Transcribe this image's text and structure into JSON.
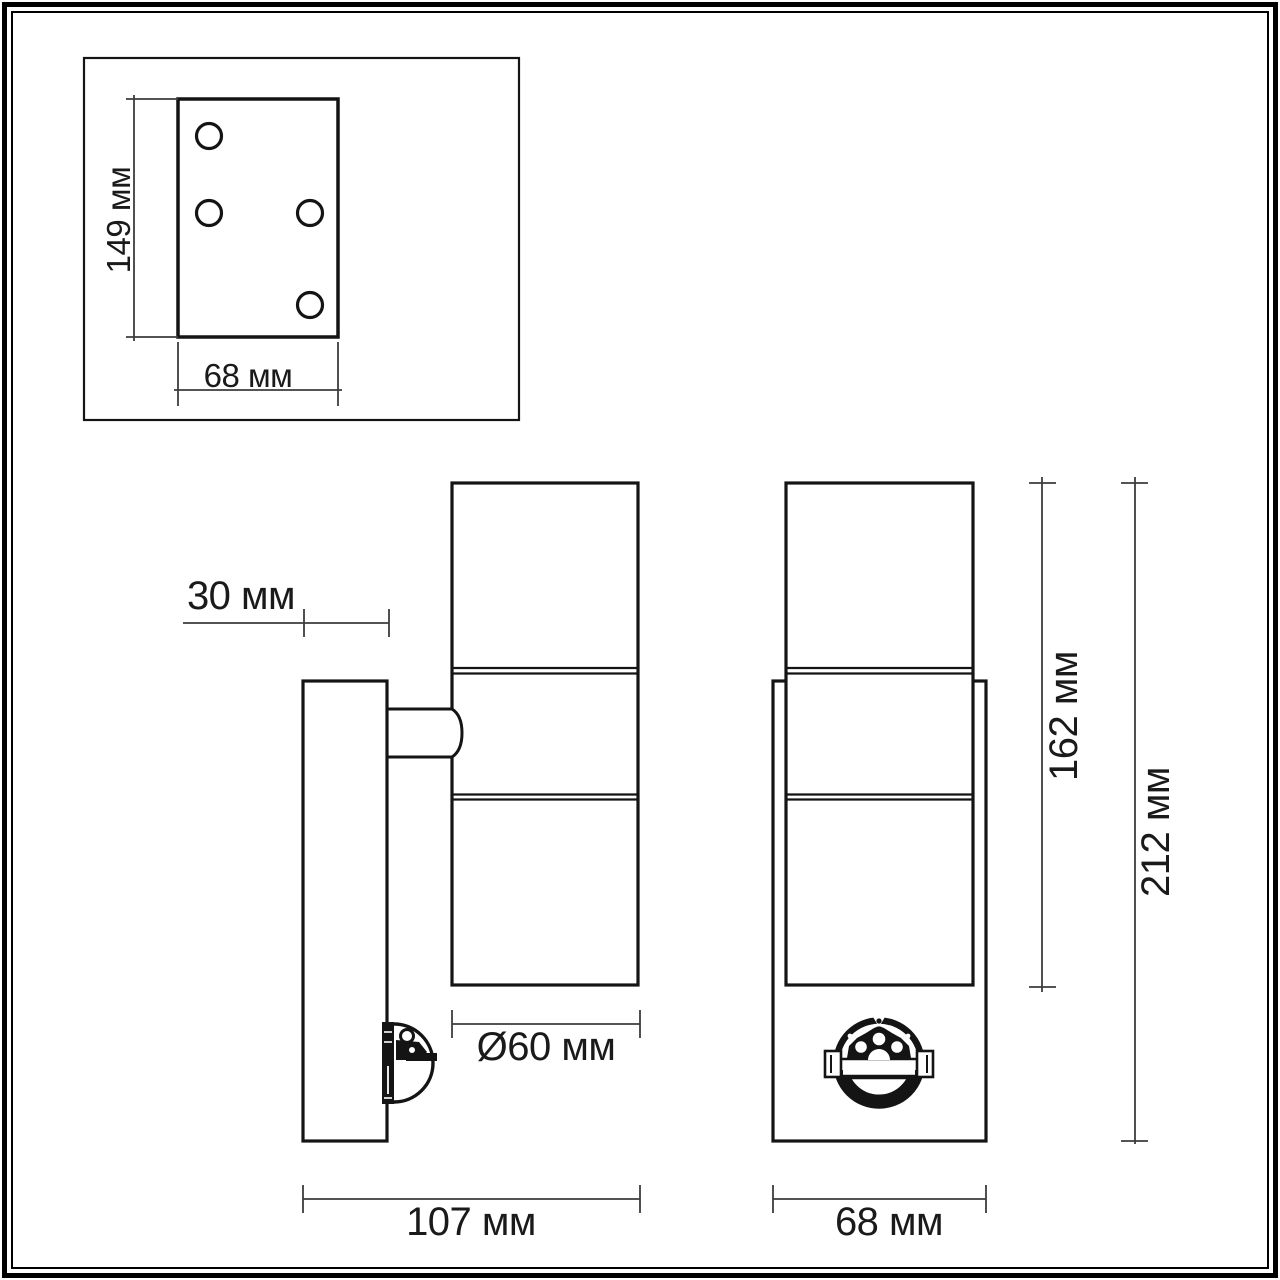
{
  "colors": {
    "background": "#ffffff",
    "object_line": "#141414",
    "dimension_line": "#3c3c3c",
    "text": "#1a1a1a"
  },
  "mounting_plate_inset": {
    "height": "149 мм",
    "width": "68 мм"
  },
  "side_view": {
    "wall_plate_depth": "30 мм",
    "shade_diameter": "Ø60 мм",
    "total_depth": "107 мм"
  },
  "front_view": {
    "body_height": "162 мм",
    "total_height": "212 мм",
    "width": "68 мм"
  }
}
